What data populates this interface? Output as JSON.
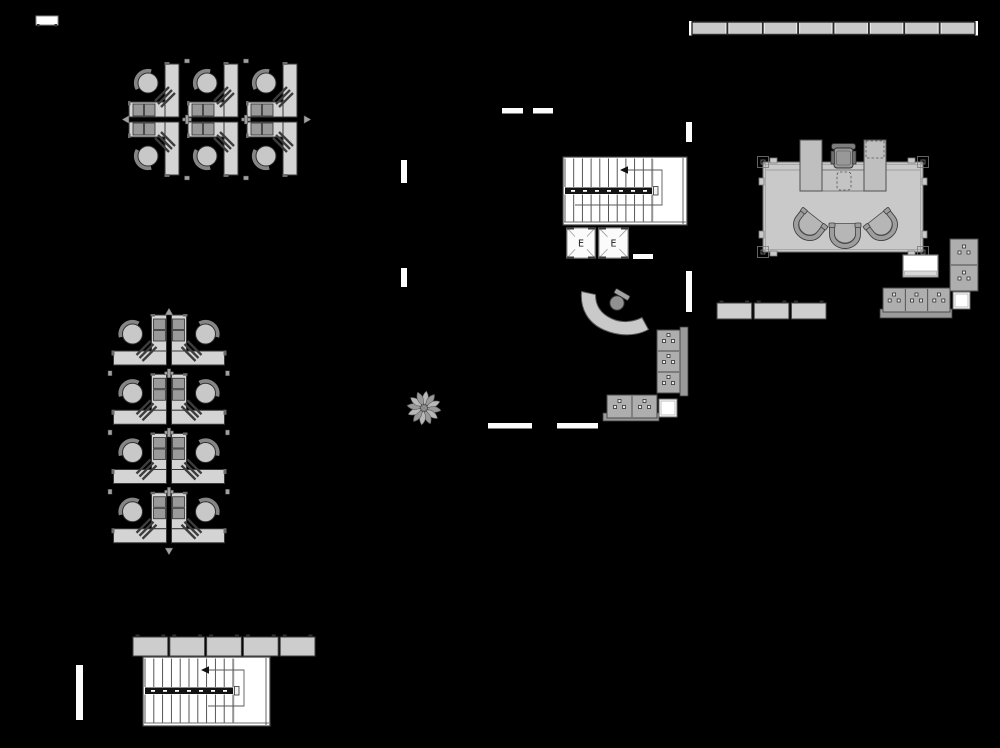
{
  "canvas": {
    "width": 1000,
    "height": 748,
    "background": "#000000"
  },
  "palette": {
    "desk_fill": "#d4d4d4",
    "desk_stroke": "#383838",
    "chair_fill": "#c8c8c8",
    "chair_stroke": "#2f2f2f",
    "chair_back": "#858585",
    "pedestal_fill": "#9a9a9a",
    "hatch_line": "#3d3d3d",
    "junction_fill": "#a0a0a0",
    "wall_white": "#fcfcfc",
    "window_fill": "#c9c9c9",
    "window_stroke": "#2a2a2a",
    "stair_fill": "#ffffff",
    "stair_line": "#3f3f3f",
    "rail_fill": "#141414",
    "path_line": "#5a5a5a",
    "elevator_fill": "#fbfbfb",
    "elevator_line": "#9c9c9c",
    "elevator_text": "#1a1a1a",
    "room_fill": "#c9c9c9",
    "room_stroke": "#6e6e6e",
    "panel_fill": "#bfbfbf",
    "panel_stroke": "#4f4f4f",
    "guest_back": "#9e9e9e",
    "guest_seat": "#b6b6b6",
    "cabinet_fill": "#aeaeae",
    "cabinet_stroke": "#4a4a4a",
    "handle_fill": "#ededed",
    "base_fill": "#9a9a9a",
    "credenza_fill": "#cecece",
    "locker_fill": "#cdcdcd",
    "nub_fill": "#2f2f2f",
    "white_fill": "#ffffff",
    "plant_fill_a": "#b8b8b8",
    "plant_fill_b": "#999999",
    "plant_stroke": "#5f5f5f",
    "plant_center": "#8c8c8c"
  },
  "window_strip": {
    "x": 692,
    "y": 22,
    "w": 283,
    "h": 12.5,
    "segments": 8
  },
  "small_table": {
    "x": 36,
    "y": 16,
    "w": 22,
    "h": 9
  },
  "lockers": {
    "x": 133,
    "y": 637,
    "h": 19,
    "seg_w": 34.8,
    "gap": 2,
    "segments": 5
  },
  "credenzas": {
    "x": 717,
    "y": 303,
    "h": 16,
    "seg_w": 34.7,
    "gap": 2.5,
    "segments": 3
  },
  "wall_segments": [
    {
      "x": 502,
      "y": 108,
      "w": 21,
      "h": 5.5
    },
    {
      "x": 533,
      "y": 108,
      "w": 20,
      "h": 5.5
    },
    {
      "x": 401,
      "y": 160,
      "w": 6,
      "h": 23
    },
    {
      "x": 401,
      "y": 268,
      "w": 6,
      "h": 19
    },
    {
      "x": 686,
      "y": 122,
      "w": 6,
      "h": 20
    },
    {
      "x": 686,
      "y": 271,
      "w": 6,
      "h": 41
    },
    {
      "x": 633,
      "y": 254,
      "w": 20,
      "h": 5
    },
    {
      "x": 488,
      "y": 423,
      "w": 44,
      "h": 5.5
    },
    {
      "x": 557,
      "y": 423,
      "w": 41,
      "h": 5.5
    },
    {
      "x": 76,
      "y": 665,
      "w": 7,
      "h": 55
    }
  ],
  "pod": {
    "w": 59,
    "h": 115
  },
  "clusters": [
    {
      "id": "cubicle-cluster-top",
      "x": 128,
      "y": 62,
      "pods": 3,
      "rotated": false
    },
    {
      "id": "cubicle-cluster-left",
      "x": 111,
      "y": 314,
      "pods": 4,
      "rotated": true,
      "row_h": 59.25
    }
  ],
  "stairwells": [
    {
      "id": "stairwell-upper",
      "x": 563,
      "y": 157,
      "w": 124,
      "h": 68,
      "tread_start": 565,
      "tread_end": 652,
      "treads": 11,
      "arrow_x": 621,
      "loop_x": 662,
      "end_x": 575
    },
    {
      "id": "stairwell-lower",
      "x": 143,
      "y": 657,
      "w": 127,
      "h": 69,
      "tread_start": 145,
      "tread_end": 233,
      "treads": 11,
      "arrow_x": 202,
      "loop_x": 244,
      "end_x": 208
    }
  ],
  "elevators": {
    "label": "E",
    "units": [
      {
        "x": 567,
        "y": 228,
        "w": 28,
        "h": 30
      },
      {
        "x": 599,
        "y": 228,
        "w": 29,
        "h": 30
      }
    ]
  },
  "executive_office": {
    "room": {
      "x": 763,
      "y": 162,
      "w": 160,
      "h": 90
    },
    "desk_line_y": 170,
    "left_panel": {
      "x": 800,
      "y": 140,
      "w": 22,
      "h": 51
    },
    "right_panel": {
      "x": 864,
      "y": 140,
      "w": 22,
      "h": 51
    },
    "dashed_top": {
      "x": 866,
      "y": 141,
      "w": 18,
      "h": 17
    },
    "center_desk": {
      "x": 822,
      "y": 170,
      "w": 42,
      "h": 21
    },
    "dashed_center": {
      "x": 837,
      "y": 172,
      "w": 14,
      "h": 18
    },
    "chair_cx": 843.5,
    "guest_chairs": [
      {
        "x": 810,
        "y": 224,
        "rot": 38
      },
      {
        "x": 845,
        "y": 232,
        "rot": 0
      },
      {
        "x": 881,
        "y": 224,
        "rot": -38
      }
    ]
  },
  "side_furniture": {
    "white_table": {
      "x": 903,
      "y": 255,
      "w": 35,
      "h": 22
    },
    "file_cabinet_tall": {
      "x": 950,
      "y": 239,
      "w": 28,
      "h": 52,
      "cells": 2,
      "dir": "v"
    },
    "white_square_a": {
      "x": 953,
      "y": 292,
      "w": 17,
      "h": 17
    },
    "office_base": {
      "x": 880,
      "y": 309,
      "w": 72,
      "h": 9
    },
    "file_cabinet_wide": {
      "x": 883,
      "y": 288,
      "w": 67,
      "h": 24,
      "cells": 3,
      "dir": "h"
    }
  },
  "reception": {
    "desk_path": "M 581.5,291.5 C 580,309 588,323 604,330 C 620,337 637,336 648.5,329.5 L 642,317.5 C 632,322.5 621,323 611.5,318.5 C 600.5,313.5 595.5,305 595.5,294.5 Z",
    "chair": {
      "cx": 617,
      "cy": 303,
      "r": 7.2,
      "back_x": 622,
      "back_y": 294.5,
      "back_rot": 30
    },
    "cab_side_strip": {
      "x": 680,
      "y": 327,
      "w": 8,
      "h": 69
    },
    "cab_vertical": {
      "x": 657,
      "y": 330,
      "w": 23,
      "h": 63,
      "cells": 3,
      "dir": "v"
    },
    "cab_base": {
      "x": 603,
      "y": 413,
      "w": 56,
      "h": 8
    },
    "cab_horizontal": {
      "x": 607,
      "y": 395,
      "w": 50,
      "h": 23,
      "cells": 2,
      "dir": "h"
    },
    "white_square_b": {
      "x": 659,
      "y": 399,
      "w": 18,
      "h": 18
    }
  },
  "plant": {
    "cx": 424,
    "cy": 408,
    "petals": 12,
    "inner_r": 3.4,
    "outer_r": 17
  }
}
